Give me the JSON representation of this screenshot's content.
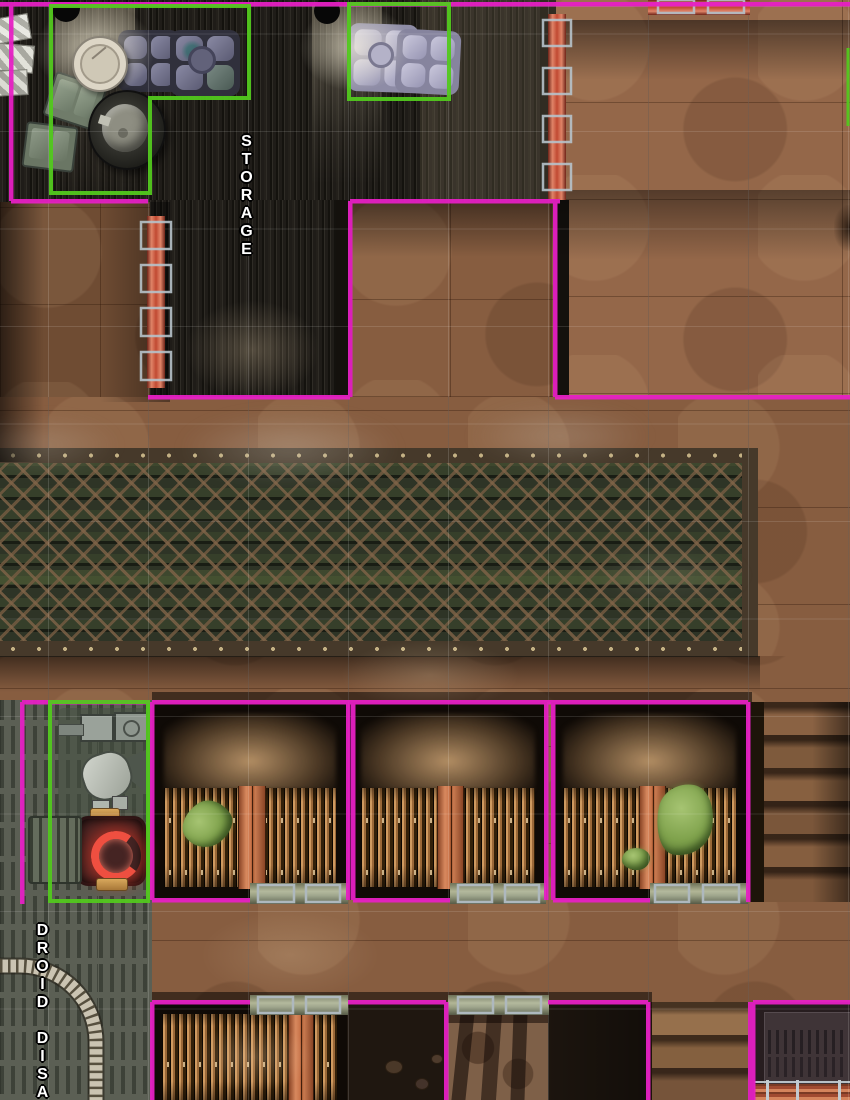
{
  "map": {
    "type": "sci-fi interior battle map, top-down view",
    "grid_size_px": 100,
    "labels": [
      {
        "id": "storage",
        "text": "STORAGE",
        "orientation": "vertical-stacked"
      },
      {
        "id": "droid-disassembly",
        "text": "DROID DISASS",
        "orientation": "vertical-stacked",
        "truncated_at_bottom_edge": true
      }
    ],
    "colors": {
      "room_outline_magenta": "#e620c4",
      "highlight_box_green": "#52c81e",
      "segment_door_red": "#cf5a3e",
      "door_bracket_gray": "#b6c2ca",
      "gate_bar_khaki": "#9aa083",
      "floor_brown": "#875d40",
      "storage_floor_dark_metal": "#23211d",
      "droid_room_floor": "#5b5f54",
      "grate_lattice_rust": "#6e5743",
      "wood_slat_orange": "#b07a48",
      "stall_door_orange": "#c9764e",
      "slime_green": "#7fa854",
      "furnace_glow_red": "#ff5548",
      "stair_stone_brown": "#85603f"
    },
    "rooms": [
      {
        "name": "storage room",
        "label": "STORAGE",
        "floor": "dark metal plank grating"
      },
      {
        "name": "upper-right hall",
        "floor": "brown tile"
      },
      {
        "name": "brown alcove",
        "floor": "brown tile"
      },
      {
        "name": "conveyor trench",
        "floor": "diamond lattice grate over green slats"
      },
      {
        "name": "stall 1",
        "contents": "dirt haze, wood slat fence, orange door, slime blob"
      },
      {
        "name": "stall 2",
        "contents": "dirt haze, wood slat fence, orange door"
      },
      {
        "name": "stall 3",
        "contents": "dirt haze, wood slat fence, orange door, slime blobs"
      },
      {
        "name": "droid disassembly room",
        "label": "DROID DISASS",
        "floor": "gray vented deck with curved conveyor track"
      },
      {
        "name": "lower stall",
        "contents": "wood slat fence, orange door"
      },
      {
        "name": "lower rock pit",
        "floor": "dark rock with barred-light shadows"
      },
      {
        "name": "lower-right chamber",
        "contents": "vent panel, striped conveyor band with railing"
      },
      {
        "name": "upper stairs",
        "steps": 6
      },
      {
        "name": "lower stairs",
        "steps": 3
      }
    ],
    "features": {
      "red_segment_doors": 3,
      "khaki_gate_bars": 5,
      "green_highlight_boxes": 4,
      "slime_blobs": 3,
      "wall_lamps": 2
    },
    "objects": [
      "control console with tile pads",
      "light control console pair",
      "round table",
      "dark mixing vat",
      "green supply crates",
      "white striped crates",
      "droid disassembler with glowing red furnace",
      "slatted crate",
      "segmented conveyor track"
    ]
  }
}
